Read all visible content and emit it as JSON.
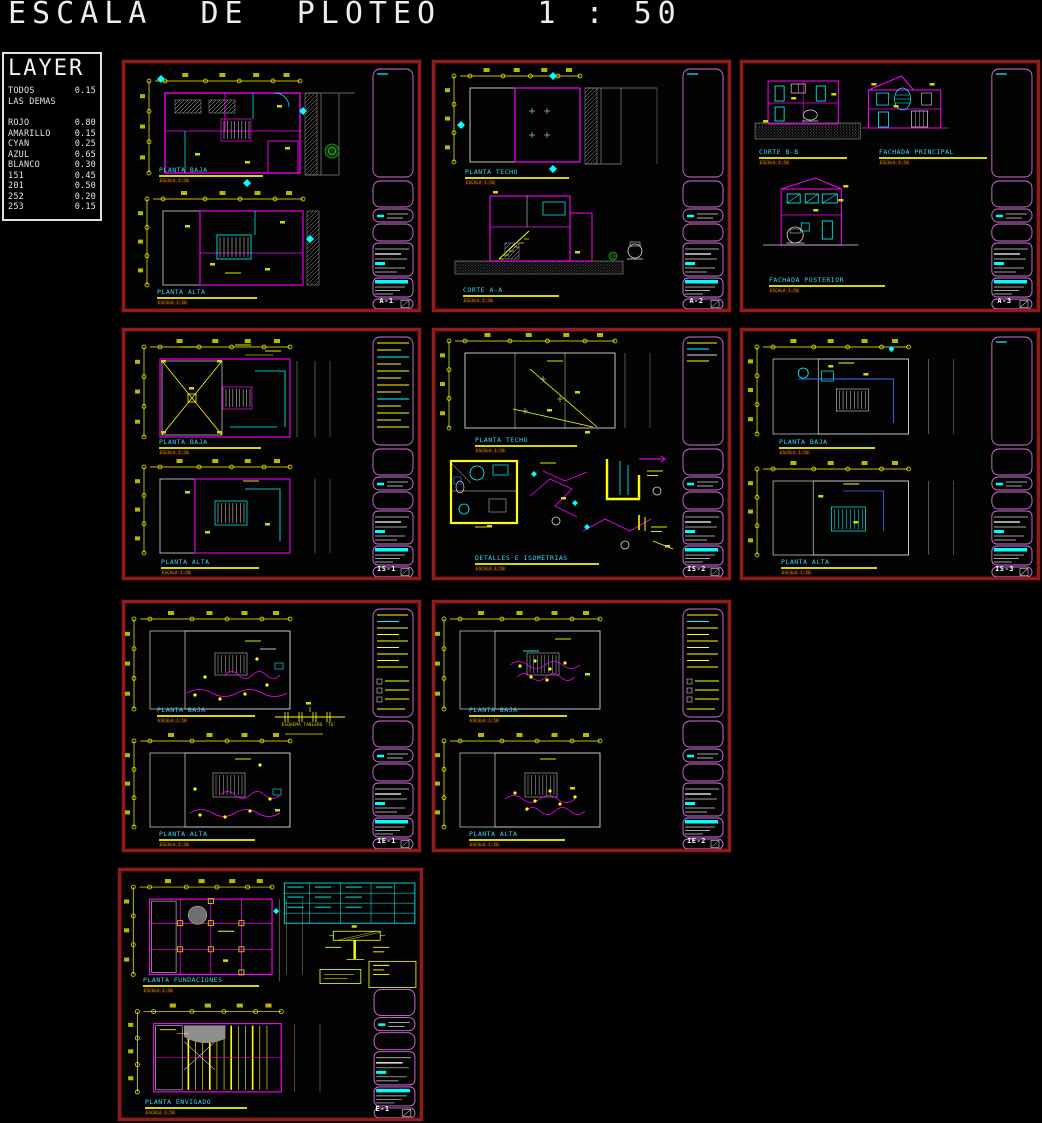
{
  "header": {
    "title": "ESCALA  DE  PLOTEO    1 : 50"
  },
  "layer_panel": {
    "title": "LAYER",
    "entries": [
      {
        "name": "TODOS",
        "value": "0.15"
      },
      {
        "name": "LAS DEMAS",
        "value": ""
      },
      {
        "name": "ROJO",
        "value": "0.80"
      },
      {
        "name": "AMARILLO",
        "value": "0.15"
      },
      {
        "name": "CYAN",
        "value": "0.25"
      },
      {
        "name": "AZUL",
        "value": "0.65"
      },
      {
        "name": "BLANCO",
        "value": "0.30"
      },
      {
        "name": "151",
        "value": "0.45"
      },
      {
        "name": "201",
        "value": "0.50"
      },
      {
        "name": "252",
        "value": "0.20"
      },
      {
        "name": "253",
        "value": "0.15"
      }
    ]
  },
  "sheets": [
    {
      "number": "A-1",
      "plans": [
        {
          "title": "PLANTA BAJA",
          "scale": "ESCALA 1:50"
        },
        {
          "title": "PLANTA ALTA",
          "scale": "ESCALA 1:50"
        }
      ]
    },
    {
      "number": "A-2",
      "plans": [
        {
          "title": "PLANTA TECHO",
          "scale": "ESCALA 1:50"
        },
        {
          "title": "CORTE A-A",
          "scale": "ESCALA 1:50"
        }
      ]
    },
    {
      "number": "A-3",
      "plans": [
        {
          "title": "CORTE B-B",
          "scale": "ESCALA 1:50"
        },
        {
          "title": "FACHADA PRINCIPAL",
          "scale": "ESCALA 1:50"
        },
        {
          "title": "FACHADA POSTERIOR",
          "scale": "ESCALA 1:50"
        }
      ]
    },
    {
      "number": "IS-1",
      "plans": [
        {
          "title": "PLANTA BAJA",
          "scale": "ESCALA 1:50"
        },
        {
          "title": "PLANTA ALTA",
          "scale": "ESCALA 1:50"
        }
      ]
    },
    {
      "number": "IS-2",
      "plans": [
        {
          "title": "PLANTA TECHO",
          "scale": "ESCALA 1:50"
        },
        {
          "title": "DETALLES E ISOMETRIAS",
          "scale": "ESCALA 1:50"
        }
      ]
    },
    {
      "number": "IS-3",
      "plans": [
        {
          "title": "PLANTA BAJA",
          "scale": "ESCALA 1:50"
        },
        {
          "title": "PLANTA ALTA",
          "scale": "ESCALA 1:50"
        }
      ]
    },
    {
      "number": "IE-1",
      "plans": [
        {
          "title": "PLANTA BAJA",
          "scale": "ESCALA 1:50"
        },
        {
          "title": "PLANTA ALTA",
          "scale": "ESCALA 1:50"
        }
      ],
      "extra": "ESQUEMA TABLERO 'TG'"
    },
    {
      "number": "IE-2",
      "plans": [
        {
          "title": "PLANTA BAJA",
          "scale": "ESCALA 1:50"
        },
        {
          "title": "PLANTA ALTA",
          "scale": "ESCALA 1:50"
        }
      ]
    },
    {
      "number": "E-1",
      "plans": [
        {
          "title": "PLANTA FUNDACIONES",
          "scale": "ESCALA 1:50"
        },
        {
          "title": "PLANTA ENVIGADO",
          "scale": "ESCALA 1:50"
        }
      ]
    }
  ],
  "colors": {
    "background": "#000000",
    "sheet_border": "#8c1d1d",
    "magenta": "#ff00ff",
    "cyan": "#00ffff",
    "yellow": "#ffff00",
    "white": "#e8e8e8",
    "gray": "#8a8a8a",
    "blue": "#3c64ff",
    "green": "#2f8f2f",
    "title_text": "#35d7f2"
  }
}
